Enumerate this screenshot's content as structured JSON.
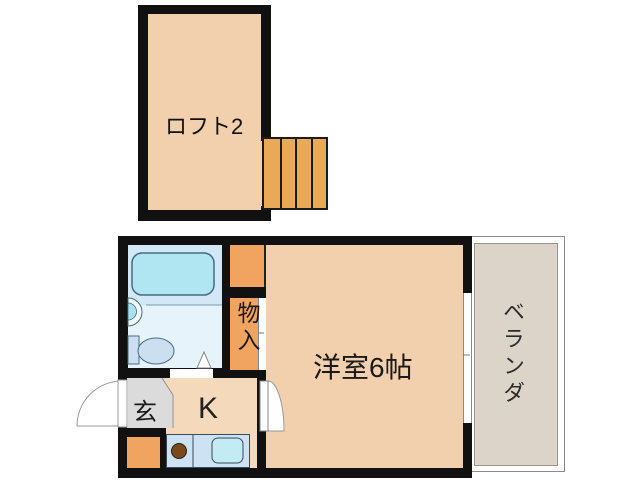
{
  "loft": {
    "label": "ロフト2"
  },
  "main_floor": {
    "western_room": {
      "label": "洋室6帖"
    },
    "kitchen": {
      "label": "K"
    },
    "entrance": {
      "label": "玄"
    },
    "storage": {
      "label": "物入"
    },
    "veranda": {
      "label": "ベランダ"
    }
  },
  "colors": {
    "wall": "#111111",
    "room_peach": "#f2cfad",
    "kitchen_peach": "#f5d9bb",
    "closet_orange": "#f0a45f",
    "stairs_orange": "#e9a957",
    "bathroom_blue": "#e7f3fb",
    "bath_zone_blue": "#d2e8f6",
    "bathtub_cyan": "#b0e6f2",
    "counter_blue": "#cde2f3",
    "sink_cyan": "#c3ebf4",
    "burner_brown": "#7b4a1c",
    "entrance_gray": "#dbdbdb",
    "veranda_gray": "#dcd4c9"
  }
}
